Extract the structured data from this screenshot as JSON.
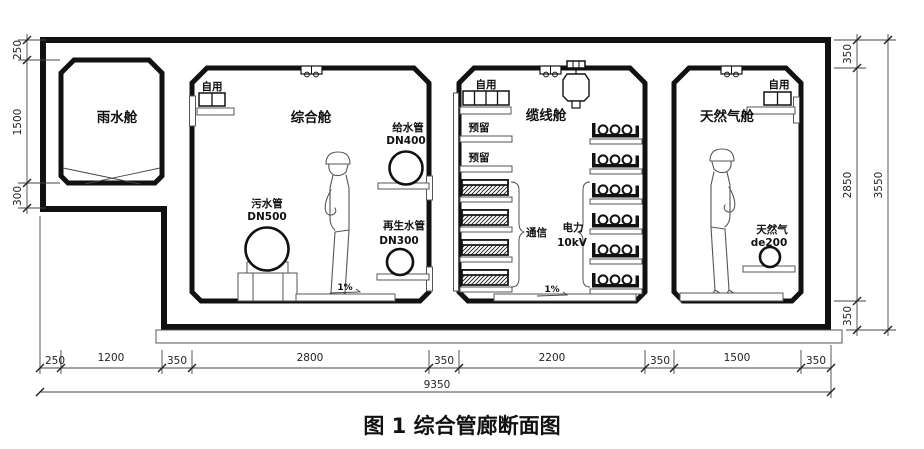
{
  "figure": {
    "title": "图 1 综合管廊断面图"
  },
  "compartments": {
    "rain": {
      "label": "雨水舱"
    },
    "utility": {
      "label": "综合舱",
      "self_use": "自用",
      "supply_pipe": {
        "name": "给水管",
        "size": "DN400"
      },
      "sewage_pipe": {
        "name": "污水管",
        "size": "DN500"
      },
      "reclaimed_pipe": {
        "name": "再生水管",
        "size": "DN300"
      },
      "slope": "1%"
    },
    "cable": {
      "label": "缆线舱",
      "self_use": "自用",
      "reserved1": "预留",
      "reserved2": "预留",
      "telecom": "通信",
      "power": "电力",
      "power_voltage": "10kV",
      "slope": "1%"
    },
    "gas": {
      "label": "天然气舱",
      "self_use": "自用",
      "gas_pipe": {
        "name": "天然气",
        "size": "de200"
      }
    }
  },
  "dimensions": {
    "left": {
      "top": "250",
      "middle": "1500",
      "bottom": "300"
    },
    "right": {
      "top": "350",
      "middle": "2850",
      "bottom": "350",
      "total": "3550"
    },
    "bottom": {
      "segments": [
        "250",
        "1200",
        "350",
        "2800",
        "350",
        "2200",
        "350",
        "1500",
        "350"
      ],
      "total": "9350"
    }
  }
}
